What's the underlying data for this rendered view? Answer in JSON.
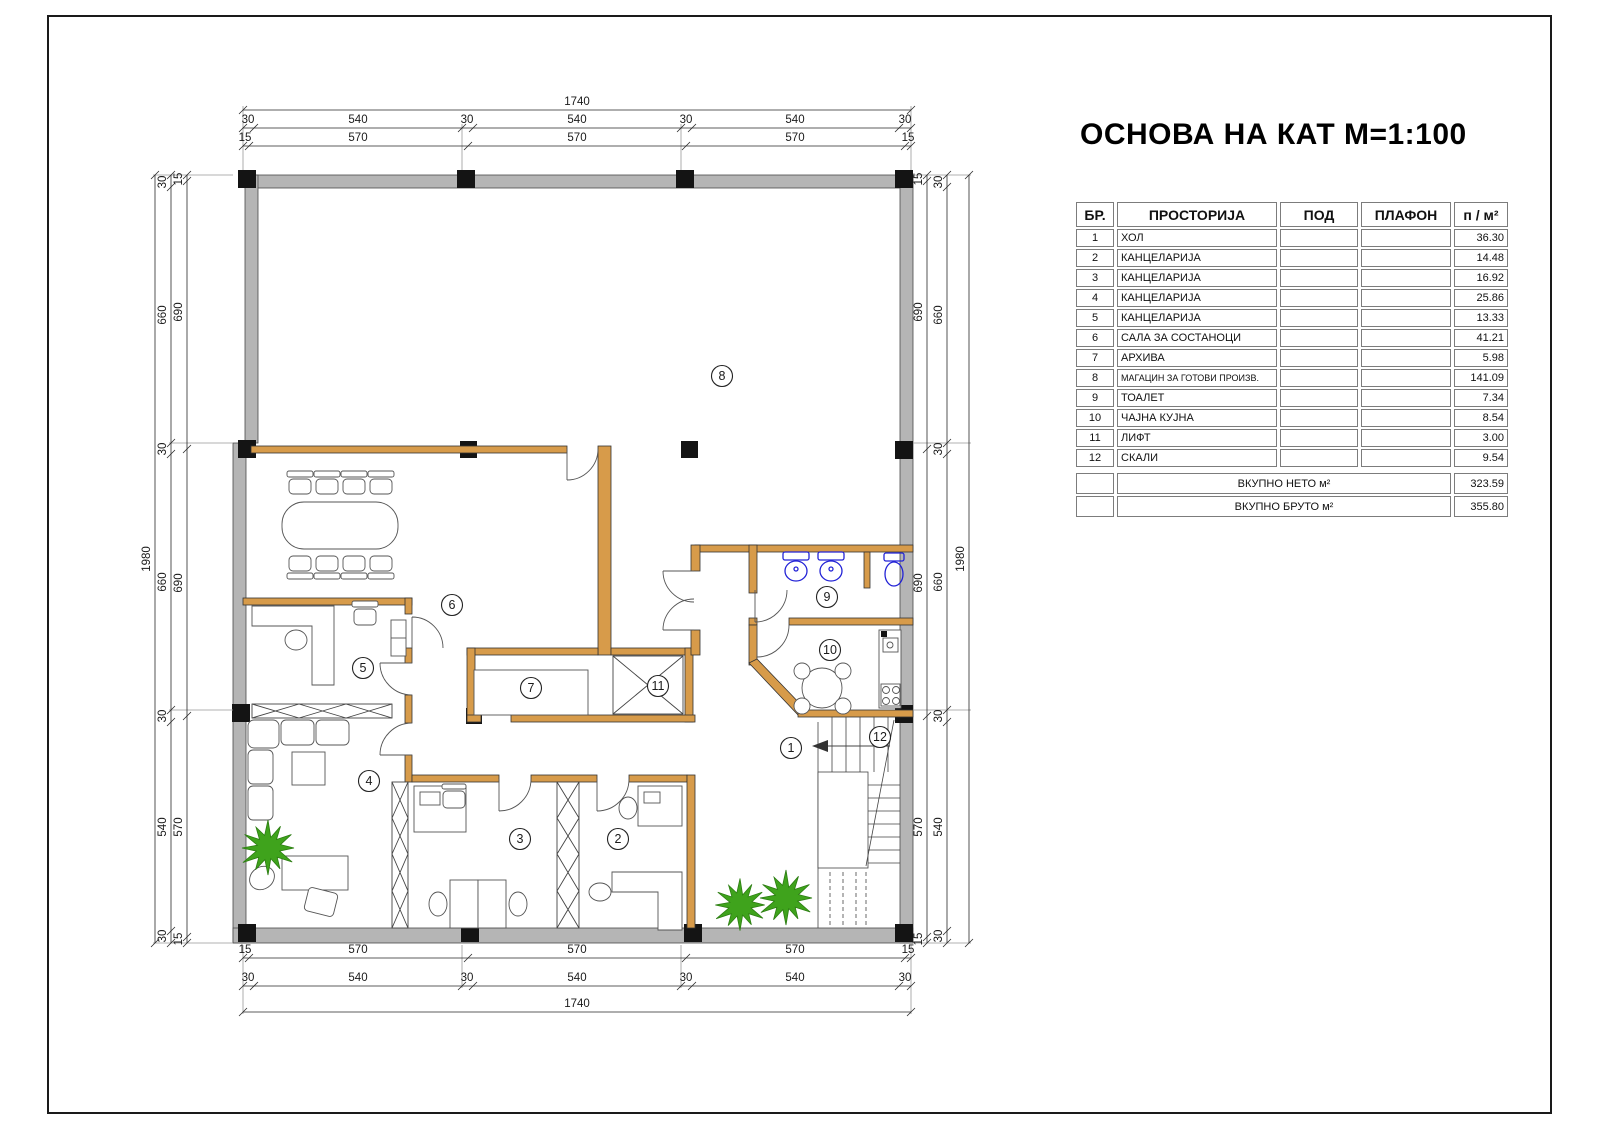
{
  "title": "ОСНОВА НА КАТ М=1:100",
  "schedule": {
    "headers": {
      "no": "БР.",
      "room": "ПРОСТОРИЈА",
      "floor": "ПОД",
      "ceiling": "ПЛАФОН",
      "area": "п / м²"
    },
    "rows": [
      {
        "no": "1",
        "room": "ХОЛ",
        "floor": "",
        "ceiling": "",
        "area": "36.30"
      },
      {
        "no": "2",
        "room": "КАНЦЕЛАРИЈА",
        "floor": "",
        "ceiling": "",
        "area": "14.48"
      },
      {
        "no": "3",
        "room": "КАНЦЕЛАРИЈА",
        "floor": "",
        "ceiling": "",
        "area": "16.92"
      },
      {
        "no": "4",
        "room": "КАНЦЕЛАРИЈА",
        "floor": "",
        "ceiling": "",
        "area": "25.86"
      },
      {
        "no": "5",
        "room": "КАНЦЕЛАРИЈА",
        "floor": "",
        "ceiling": "",
        "area": "13.33"
      },
      {
        "no": "6",
        "room": "САЛА ЗА СОСТАНОЦИ",
        "floor": "",
        "ceiling": "",
        "area": "41.21"
      },
      {
        "no": "7",
        "room": "АРХИВА",
        "floor": "",
        "ceiling": "",
        "area": "5.98"
      },
      {
        "no": "8",
        "room": "МАГАЦИН ЗА ГОТОВИ ПРОИЗВ.",
        "floor": "",
        "ceiling": "",
        "area": "141.09"
      },
      {
        "no": "9",
        "room": "ТОАЛЕТ",
        "floor": "",
        "ceiling": "",
        "area": "7.34"
      },
      {
        "no": "10",
        "room": "ЧАЈНА КУЈНА",
        "floor": "",
        "ceiling": "",
        "area": "8.54"
      },
      {
        "no": "11",
        "room": "ЛИФТ",
        "floor": "",
        "ceiling": "",
        "area": "3.00"
      },
      {
        "no": "12",
        "room": "СКАЛИ",
        "floor": "",
        "ceiling": "",
        "area": "9.54"
      }
    ],
    "totals": [
      {
        "label": "ВКУПНО НЕТО м²",
        "value": "323.59"
      },
      {
        "label": "ВКУПНО БРУТО м²",
        "value": "355.80"
      }
    ]
  },
  "plan": {
    "rooms": [
      {
        "n": "1"
      },
      {
        "n": "2"
      },
      {
        "n": "3"
      },
      {
        "n": "4"
      },
      {
        "n": "5"
      },
      {
        "n": "6"
      },
      {
        "n": "7"
      },
      {
        "n": "8"
      },
      {
        "n": "9"
      },
      {
        "n": "10"
      },
      {
        "n": "11"
      },
      {
        "n": "12"
      }
    ],
    "dims": {
      "h_overall": "1740",
      "h_outer": [
        "30",
        "540",
        "30",
        "540",
        "30",
        "540",
        "30"
      ],
      "h_inner": [
        "15",
        "570",
        "570",
        "570",
        "15"
      ],
      "v_overall": "1980",
      "v_outer": [
        "30",
        "660",
        "30",
        "660",
        "30",
        "540",
        "30"
      ],
      "v_inner": [
        "15",
        "690",
        "690",
        "570",
        "15"
      ]
    },
    "colors": {
      "wall": "#b5b5b5",
      "column": "#141414",
      "partition": "#d79b4a",
      "fixture": "#2323d6",
      "plant": "#3fa31c"
    }
  }
}
